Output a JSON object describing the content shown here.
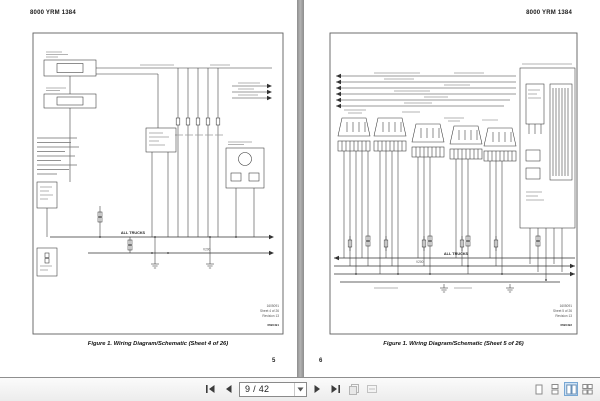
{
  "toolbar": {
    "page_display": "9 / 42"
  },
  "pages": {
    "left": {
      "header": "8000 YRM 1384",
      "caption": "Figure 1. Wiring Diagram/Schematic (Sheet 4 of 26)",
      "page_number": "5",
      "labels": {
        "all_trucks": "ALL TRUCKS",
        "wire_ref": "V200"
      },
      "title_block": {
        "drawing_number": "1605091",
        "sheet": "Sheet 4 of 26",
        "revision": "Revision 13",
        "plot_number": "6690491"
      }
    },
    "right": {
      "header": "8000 YRM 1384",
      "caption": "Figure 1. Wiring Diagram/Schematic (Sheet 5 of 26)",
      "page_number": "6",
      "labels": {
        "all_trucks": "ALL TRUCKS",
        "wire_ref": "V200"
      },
      "title_block": {
        "drawing_number": "1605091",
        "sheet": "Sheet 5 of 26",
        "revision": "Revision 13",
        "plot_number": "6690492"
      }
    }
  },
  "colors": {
    "toolbar_bg": "#f0f0f0",
    "active_view_highlight": "#cfe3f6",
    "gutter": "#9a9a9a",
    "diagram_ink": "#333333"
  }
}
